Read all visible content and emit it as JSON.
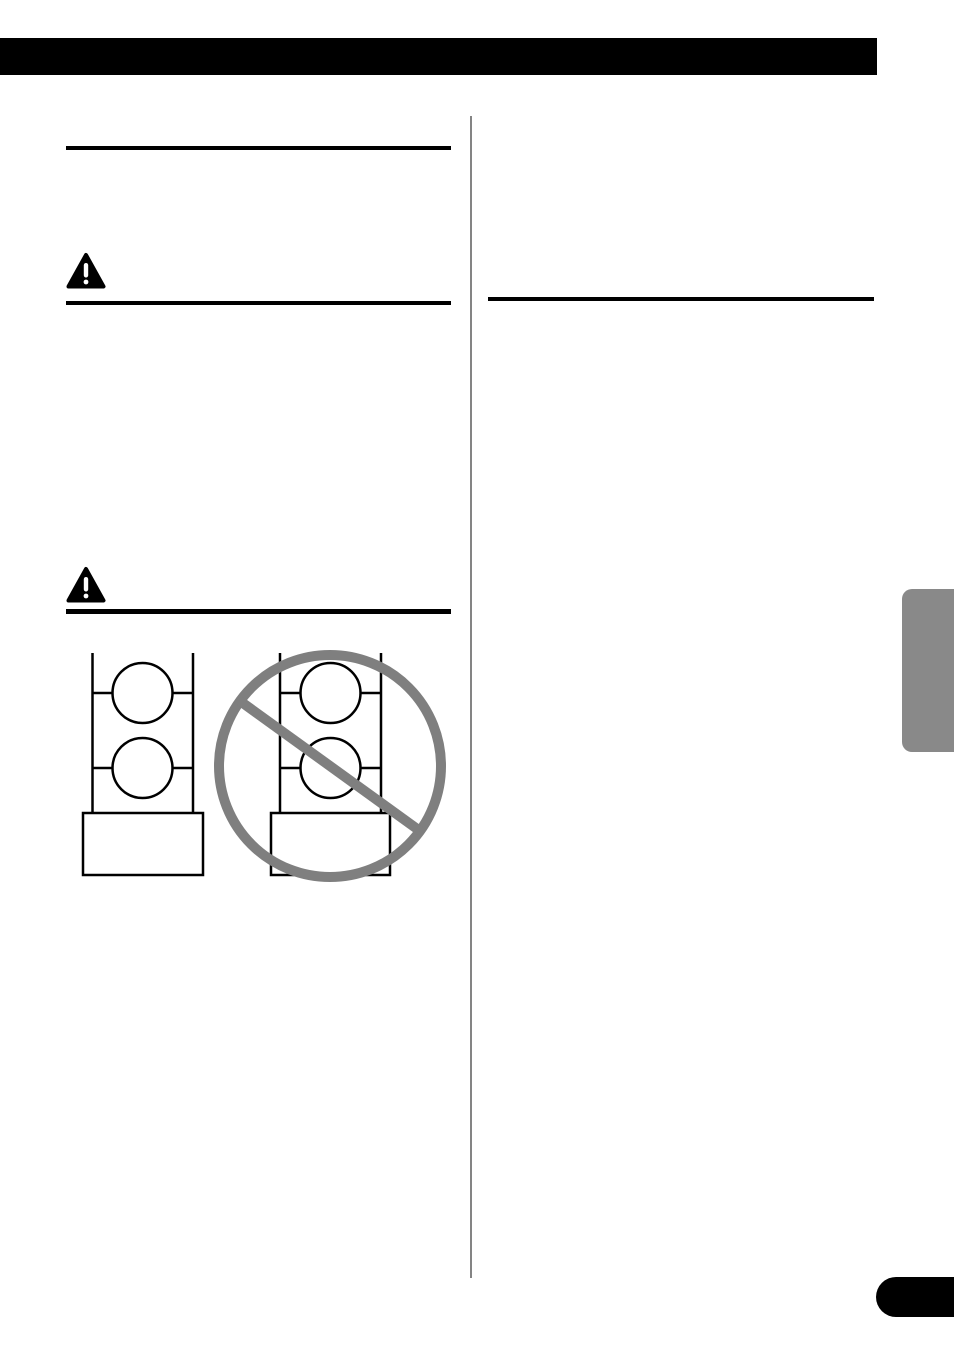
{
  "colors": {
    "ink": "#000000",
    "paper": "#ffffff",
    "divider_gray": "#848484",
    "prohibition_gray": "#7f7f7f",
    "tab_gray": "#898989"
  },
  "icons": {
    "warning_1": "warning-triangle-icon",
    "warning_2": "warning-triangle-icon",
    "prohibition": "no-sign-icon"
  }
}
